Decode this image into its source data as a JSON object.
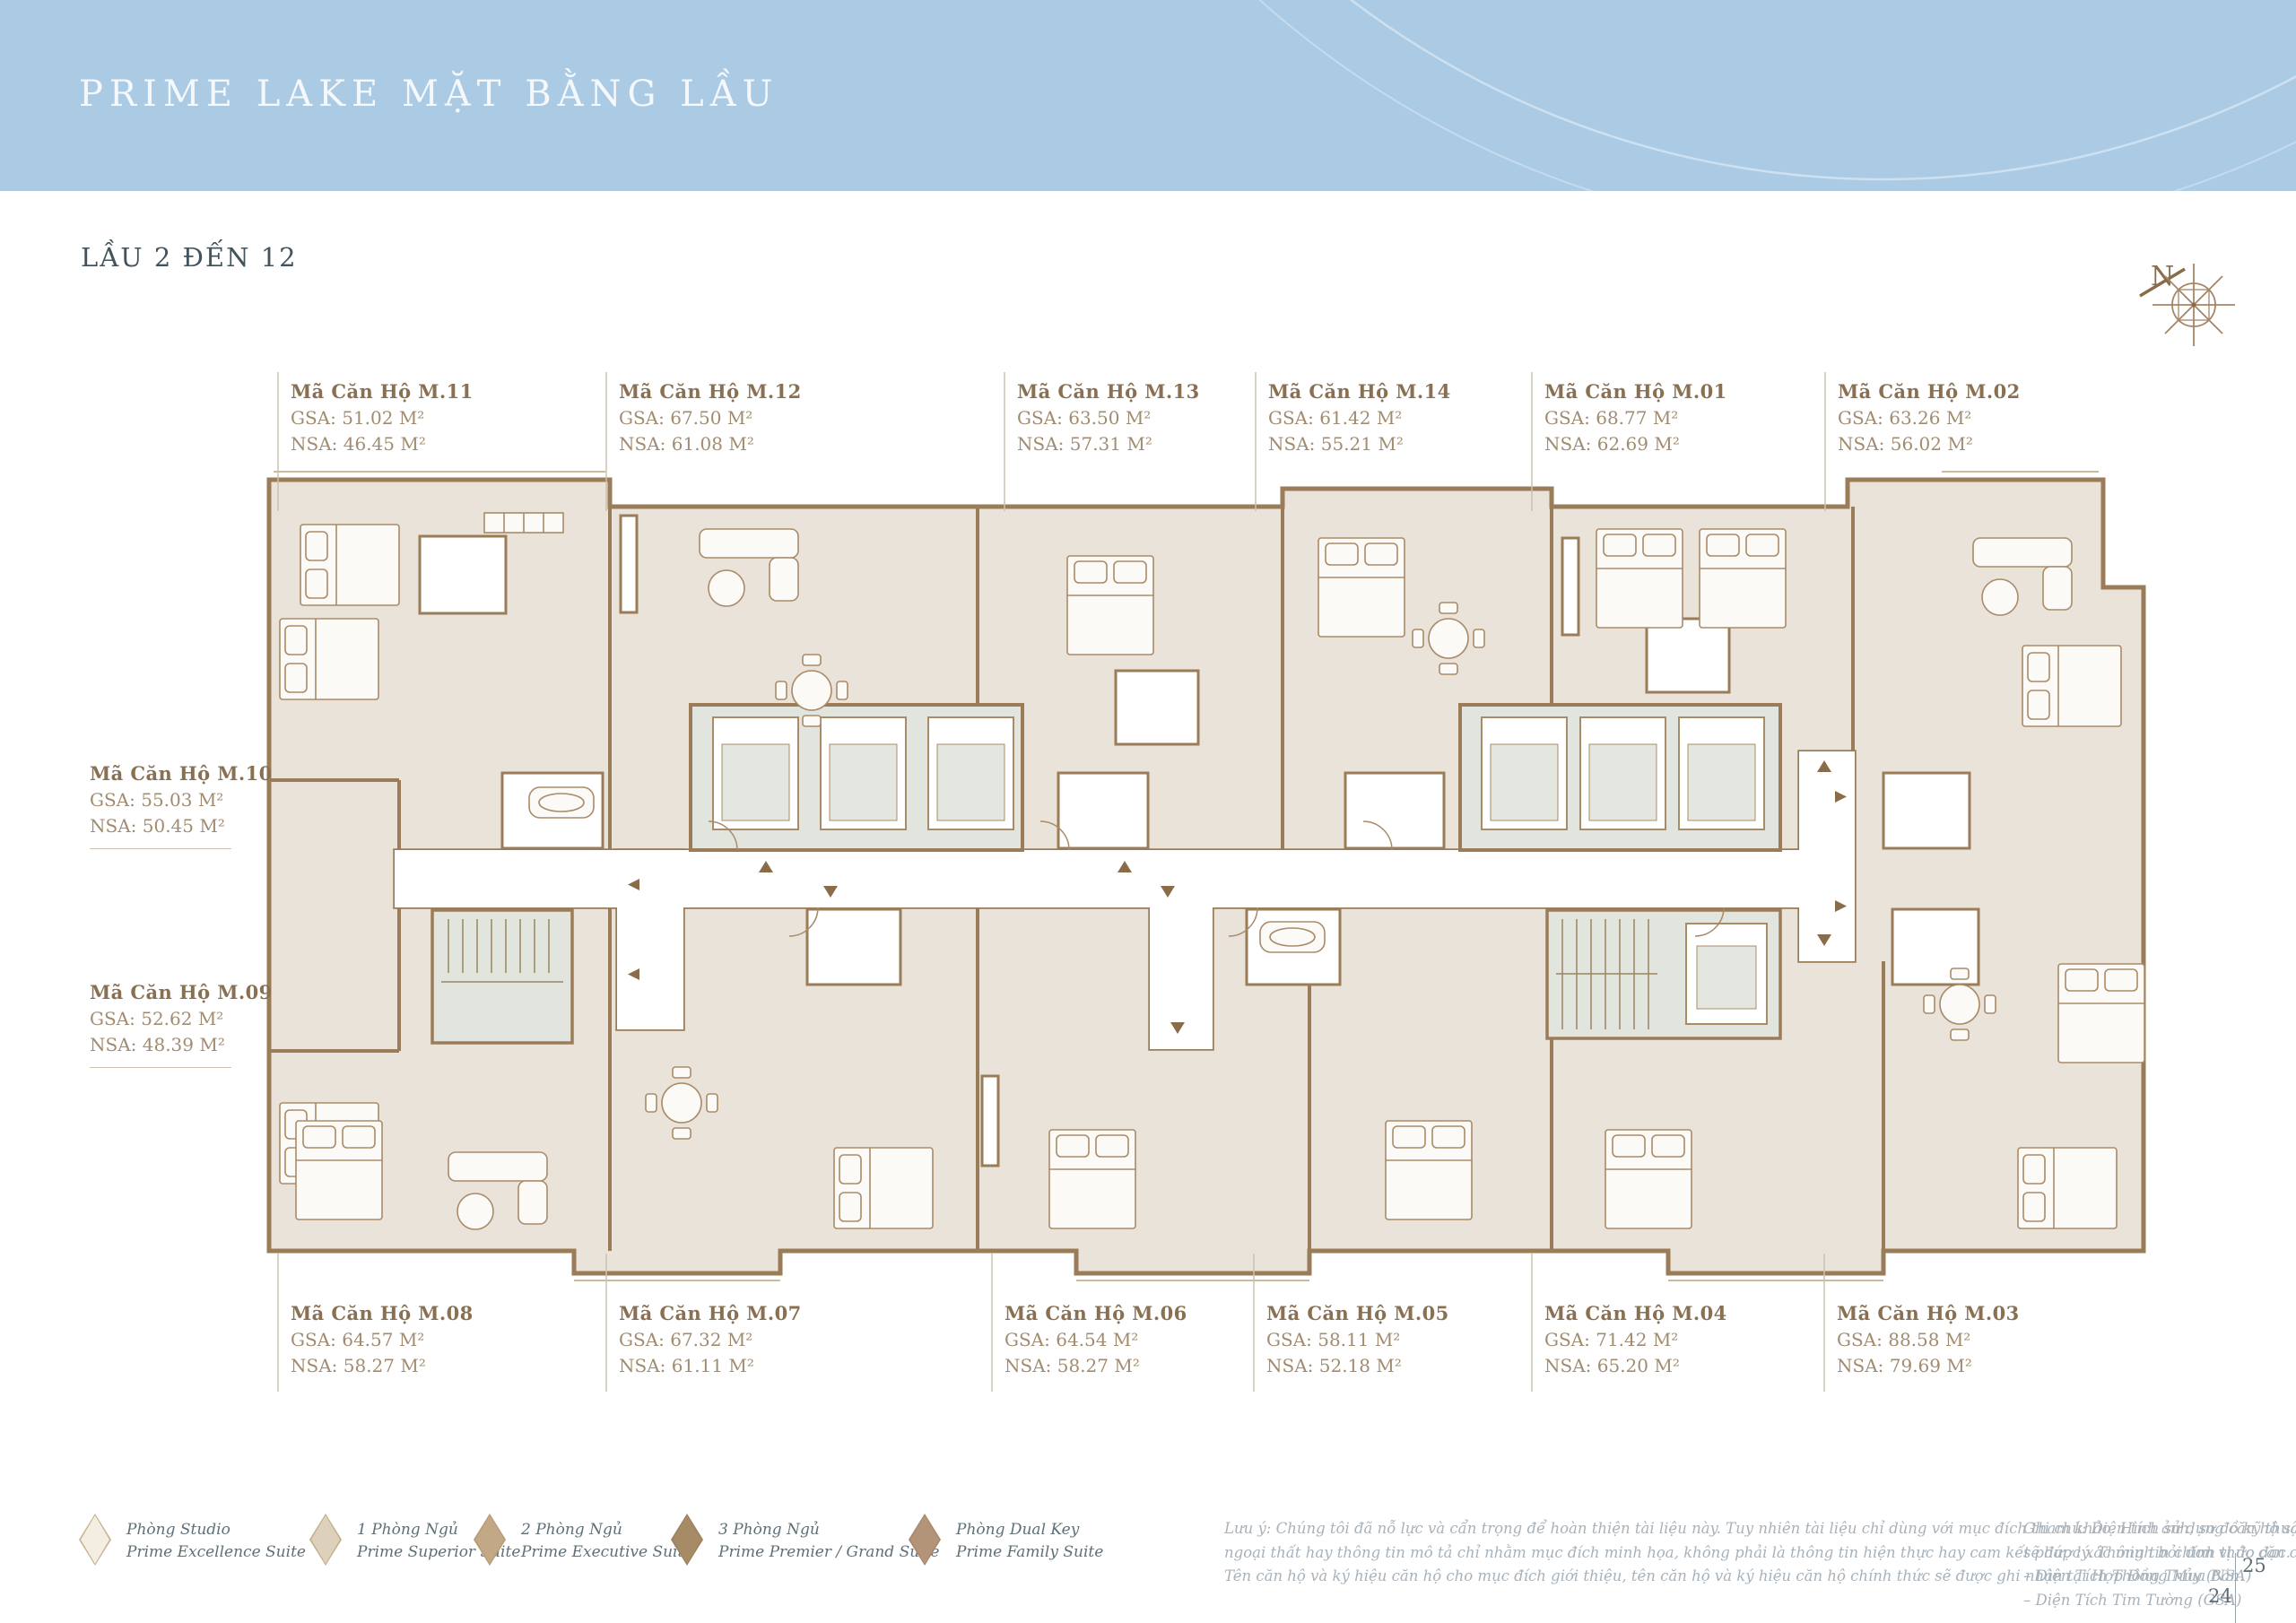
{
  "palette": {
    "banner": "#ABCBE5",
    "title": "#F5F8FB",
    "subtitle": "#43545C",
    "wall": "#9A7C58",
    "floor": "#EAE3D9",
    "core": "#E2E5DD",
    "furn": "#A98B68",
    "arrow": "#8A6C4A",
    "label-title": "#8A7052",
    "label-val": "#A28C71",
    "legend-text": "#5E7077",
    "notes-text": "#A8B2BA",
    "leader": "#CBC2B2",
    "page-num": "#5E6E74"
  },
  "banner": {
    "title": "PRIME LAKE MẶT BẰNG LẦU"
  },
  "subtitle": "LẦU 2 ĐẾN 12",
  "compass": {
    "label": "N"
  },
  "unit_labels": {
    "top": [
      {
        "title": "Mã Căn Hộ M.11",
        "gsa": "GSA: 51.02 M²",
        "nsa": "NSA: 46.45 M²"
      },
      {
        "title": "Mã Căn Hộ M.12",
        "gsa": "GSA: 67.50 M²",
        "nsa": "NSA: 61.08 M²"
      },
      {
        "title": "Mã Căn Hộ M.13",
        "gsa": "GSA: 63.50 M²",
        "nsa": "NSA: 57.31 M²"
      },
      {
        "title": "Mã Căn Hộ M.14",
        "gsa": "GSA: 61.42 M²",
        "nsa": "NSA: 55.21 M²"
      },
      {
        "title": "Mã Căn Hộ M.01",
        "gsa": "GSA: 68.77 M²",
        "nsa": "NSA: 62.69 M²"
      },
      {
        "title": "Mã Căn Hộ M.02",
        "gsa": "GSA: 63.26 M²",
        "nsa": "NSA: 56.02 M²"
      }
    ],
    "left": [
      {
        "title": "Mã Căn Hộ M.10",
        "gsa": "GSA: 55.03 M²",
        "nsa": "NSA: 50.45 M²"
      },
      {
        "title": "Mã Căn Hộ M.09",
        "gsa": "GSA: 52.62 M²",
        "nsa": "NSA: 48.39 M²"
      }
    ],
    "bottom": [
      {
        "title": "Mã Căn Hộ M.08",
        "gsa": "GSA: 64.57 M²",
        "nsa": "NSA: 58.27 M²"
      },
      {
        "title": "Mã Căn Hộ M.07",
        "gsa": "GSA: 67.32 M²",
        "nsa": "NSA: 61.11 M²"
      },
      {
        "title": "Mã Căn Hộ M.06",
        "gsa": "GSA: 64.54 M²",
        "nsa": "NSA: 58.27 M²"
      },
      {
        "title": "Mã Căn Hộ M.05",
        "gsa": "GSA: 58.11 M²",
        "nsa": "NSA: 52.18 M²"
      },
      {
        "title": "Mã Căn Hộ M.04",
        "gsa": "GSA: 71.42 M²",
        "nsa": "NSA: 65.20 M²"
      },
      {
        "title": "Mã Căn Hộ M.03",
        "gsa": "GSA: 88.58 M²",
        "nsa": "NSA: 79.69 M²"
      }
    ]
  },
  "legend": {
    "items": [
      {
        "vn": "Phòng Studio",
        "en": "Prime Excellence Suite",
        "fill": "#F3EDE2",
        "border": "#C8B290"
      },
      {
        "vn": "1 Phòng Ngủ",
        "en": "Prime Superior Suite",
        "fill": "#DDD1BC",
        "border": "#C4AE8C"
      },
      {
        "vn": "2 Phòng Ngủ",
        "en": "Prime Executive Suite",
        "fill": "#C2A885",
        "border": "#B59A75"
      },
      {
        "vn": "3 Phòng Ngủ",
        "en": "Prime Premier / Grand Suite",
        "fill": "#A78B66",
        "border": "#9C8160"
      },
      {
        "vn": "Phòng Dual Key",
        "en": "Prime Family Suite",
        "fill": "#B39478",
        "border": "#A68869"
      }
    ]
  },
  "notes_left": {
    "lines": [
      "Lưu ý: Chúng tôi đã nỗ lực và cẩn trọng để hoàn thiện tài liệu này. Tuy nhiên tài liệu chỉ dùng với mục đích tham khảo. Hình ảnh, sơ đồ kỹ thuật, bố trí nội",
      "ngoại thất hay thông tin mô tả chỉ nhằm mục đích minh họa, không phải là thông tin hiện thực hay cam kết pháp lý. Thông tin chính thức căn cứ trên hợp đồng.",
      "Tên căn hộ và ký hiệu căn hộ cho mục đích giới thiệu, tên căn hộ và ký hiệu căn hộ chính thức sẽ được ghi nhận tại Hợp Đồng Mua Bán."
    ]
  },
  "notes_right": {
    "lines": [
      "Ghi chú: Diện tích sử dụng căn hộ sau cùng",
      "sẽ được xác minh bởi đơn vị đo đạc.",
      "– Diện Tích Thông Thủy (NSA)",
      "– Diện Tích Tim Tường (GSA)"
    ]
  },
  "pages": {
    "left": "24",
    "right": "25"
  }
}
